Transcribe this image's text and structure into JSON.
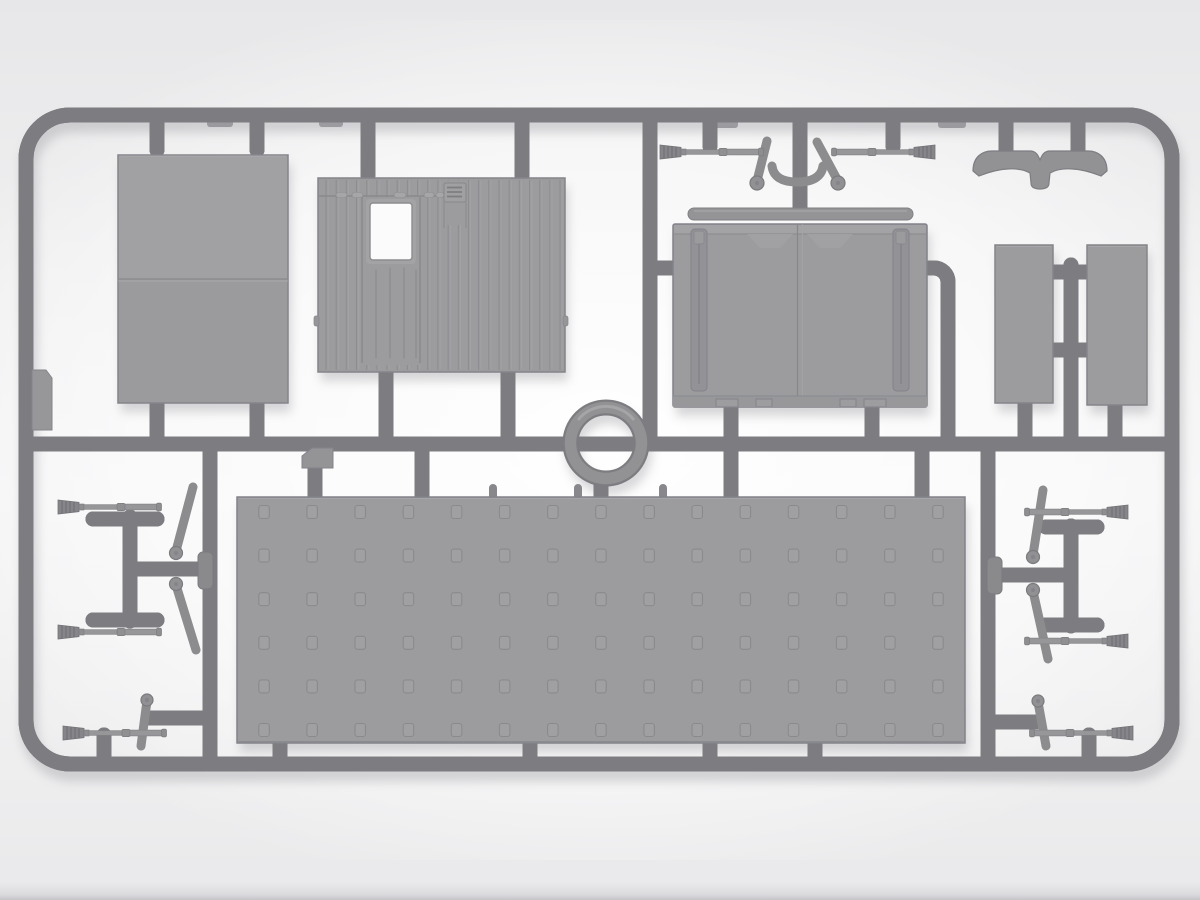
{
  "scene": {
    "title": "Gray injection-molded model kit sprue with flat panels, doors, floor plate, ring and rifle parts",
    "background_color": "#eeeeef",
    "plastic_color": "#9c9c9e",
    "runner_color": "#919194",
    "frame_shape": "rounded-rectangle"
  },
  "floor_grid": {
    "columns": 15,
    "rows": 6
  },
  "corrugation": {
    "rib_count": 24
  },
  "parts": [
    {
      "name": "large-flat-panel",
      "quantity": 1,
      "detail": "rectangular two-section panel with horizontal seam"
    },
    {
      "name": "corrugated-wall-panel",
      "quantity": 1,
      "detail": "ribbed wall with door, window opening and louvered vent"
    },
    {
      "name": "double-door-panel",
      "quantity": 1,
      "detail": "two doors with edge channels and bottom tabs"
    },
    {
      "name": "header-bar",
      "quantity": 1
    },
    {
      "name": "narrow-side-panel",
      "quantity": 2
    },
    {
      "name": "gull-wing-bracket",
      "quantity": 1
    },
    {
      "name": "ring-part",
      "quantity": 1
    },
    {
      "name": "tread-floor-panel",
      "quantity": 1,
      "detail": "15 x 6 grid of recessed squares"
    },
    {
      "name": "rifle-with-brush-muzzle",
      "quantity": 8
    },
    {
      "name": "support-arm-with-pivot-disc",
      "quantity": 8
    },
    {
      "name": "mounting-tab",
      "quantity": 2
    }
  ]
}
